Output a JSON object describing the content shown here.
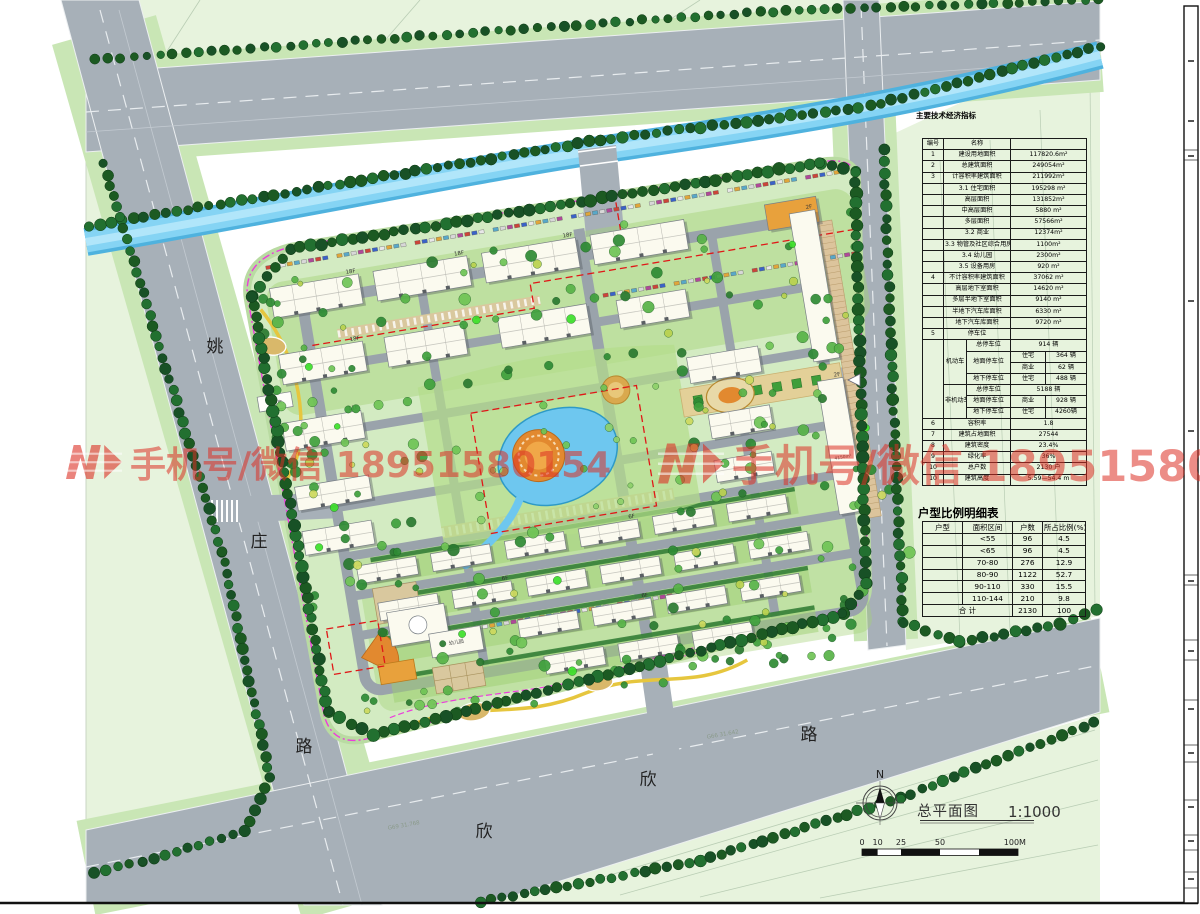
{
  "drawing": {
    "title": "总平面图",
    "scale": "1:1000",
    "north": "N",
    "scalebar_ticks": [
      "0",
      "10",
      "25",
      "50",
      "100M"
    ],
    "survey_labels": [
      "G66 31.642",
      "G69 31.768"
    ]
  },
  "roads": {
    "left": [
      "姚",
      "庄",
      "路"
    ],
    "bottom": [
      "欣",
      "欣",
      "路"
    ]
  },
  "watermark": {
    "text": "手机号/微信 18951580154"
  },
  "labels": {
    "floors": [
      "18F",
      "18F",
      "18F",
      "18F",
      "11F",
      "6F",
      "6F",
      "6F",
      "2F",
      "2F",
      "1F"
    ],
    "rooms": [
      "配电房",
      "幼儿园",
      "4150m²"
    ]
  },
  "colors": {
    "road": "#a7b0b8",
    "canal": "#6cc8ee",
    "site_green": "#d3ebc2",
    "field_green": "#e7f3dd",
    "tree_dark": "#1c5a22",
    "plaza_orange": "#e2892f",
    "boundary_magenta": "#ec3cdc",
    "redline": "#e01818",
    "watermark_red": "#dc3024"
  },
  "tables": {
    "main": {
      "title": "主要技术经济指标",
      "col_widths": [
        21,
        23,
        44,
        35,
        41
      ],
      "rows": [
        {
          "cells": [
            {
              "t": "编号"
            },
            {
              "t": "名称",
              "c": 2
            },
            {
              "t": "",
              "c": 2
            }
          ]
        },
        {
          "cells": [
            {
              "t": "1"
            },
            {
              "t": "建设用地面积",
              "c": 2
            },
            {
              "t": "117820.6m²",
              "c": 2
            }
          ]
        },
        {
          "cells": [
            {
              "t": "2"
            },
            {
              "t": "总建筑面积",
              "c": 2
            },
            {
              "t": "249054m²",
              "c": 2
            }
          ]
        },
        {
          "cells": [
            {
              "t": "3"
            },
            {
              "t": "计容积率建筑面积",
              "c": 2
            },
            {
              "t": "211992m²",
              "c": 2
            }
          ]
        },
        {
          "cells": [
            {
              "t": ""
            },
            {
              "t": "3.1 住宅面积",
              "c": 2
            },
            {
              "t": "195298 m²",
              "c": 2
            }
          ]
        },
        {
          "cells": [
            {
              "t": ""
            },
            {
              "t": "高层面积",
              "c": 2
            },
            {
              "t": "131852m²",
              "c": 2
            }
          ]
        },
        {
          "cells": [
            {
              "t": ""
            },
            {
              "t": "中高层面积",
              "c": 2
            },
            {
              "t": "5880 m²",
              "c": 2
            }
          ]
        },
        {
          "cells": [
            {
              "t": ""
            },
            {
              "t": "多层面积",
              "c": 2
            },
            {
              "t": "57566m²",
              "c": 2
            }
          ]
        },
        {
          "cells": [
            {
              "t": ""
            },
            {
              "t": "3.2 商业",
              "c": 2
            },
            {
              "t": "12374m²",
              "c": 2
            }
          ]
        },
        {
          "cells": [
            {
              "t": ""
            },
            {
              "t": "3.3 物管及社区综合用房",
              "c": 2
            },
            {
              "t": "1100m²",
              "c": 2
            }
          ]
        },
        {
          "cells": [
            {
              "t": ""
            },
            {
              "t": "3.4 幼儿园",
              "c": 2
            },
            {
              "t": "2300m²",
              "c": 2
            }
          ]
        },
        {
          "cells": [
            {
              "t": ""
            },
            {
              "t": "3.5 设备用房",
              "c": 2
            },
            {
              "t": "920 m²",
              "c": 2
            }
          ]
        },
        {
          "cells": [
            {
              "t": "4"
            },
            {
              "t": "不计容积率建筑面积",
              "c": 2
            },
            {
              "t": "37062 m²",
              "c": 2
            }
          ]
        },
        {
          "cells": [
            {
              "t": ""
            },
            {
              "t": "高层地下室面积",
              "c": 2
            },
            {
              "t": "14620 m²",
              "c": 2
            }
          ]
        },
        {
          "cells": [
            {
              "t": ""
            },
            {
              "t": "多层半地下室面积",
              "c": 2
            },
            {
              "t": "9140 m²",
              "c": 2
            }
          ]
        },
        {
          "cells": [
            {
              "t": ""
            },
            {
              "t": "半地下汽车库面积",
              "c": 2
            },
            {
              "t": "6330 m²",
              "c": 2
            }
          ]
        },
        {
          "cells": [
            {
              "t": ""
            },
            {
              "t": "地下汽车库面积",
              "c": 2
            },
            {
              "t": "9720 m²",
              "c": 2
            }
          ]
        },
        {
          "cells": [
            {
              "t": "5"
            },
            {
              "t": "停车位",
              "c": 2
            },
            {
              "t": "",
              "c": 2
            }
          ]
        },
        {
          "cells": [
            {
              "t": "",
              "r": 7
            },
            {
              "t": "机动车",
              "r": 4
            },
            {
              "t": "总停车位"
            },
            {
              "t": "914 辆",
              "c": 2
            }
          ]
        },
        {
          "cells": [
            {
              "t": "地面停车位",
              "r": 2
            },
            {
              "t": "住宅"
            },
            {
              "t": "364 辆"
            }
          ]
        },
        {
          "cells": [
            {
              "t": "商业"
            },
            {
              "t": "62 辆"
            }
          ]
        },
        {
          "cells": [
            {
              "t": "地下停车位"
            },
            {
              "t": "住宅"
            },
            {
              "t": "488 辆"
            }
          ]
        },
        {
          "cells": [
            {
              "t": "非机动车",
              "r": 3
            },
            {
              "t": "总停车位"
            },
            {
              "t": "5188 辆",
              "c": 2
            }
          ]
        },
        {
          "cells": [
            {
              "t": "地面停车位"
            },
            {
              "t": "商业"
            },
            {
              "t": "928 辆"
            }
          ]
        },
        {
          "cells": [
            {
              "t": "地下停车位"
            },
            {
              "t": "住宅"
            },
            {
              "t": "4260辆"
            }
          ]
        },
        {
          "cells": [
            {
              "t": "6"
            },
            {
              "t": "容积率",
              "c": 2
            },
            {
              "t": "1.8",
              "c": 2
            }
          ]
        },
        {
          "cells": [
            {
              "t": "7"
            },
            {
              "t": "建筑占地面积",
              "c": 2
            },
            {
              "t": "27544",
              "c": 2
            }
          ]
        },
        {
          "cells": [
            {
              "t": "8"
            },
            {
              "t": "建筑密度",
              "c": 2
            },
            {
              "t": "23.4%",
              "c": 2
            }
          ]
        },
        {
          "cells": [
            {
              "t": "9"
            },
            {
              "t": "绿化率",
              "c": 2
            },
            {
              "t": "36%",
              "c": 2
            }
          ]
        },
        {
          "cells": [
            {
              "t": "10"
            },
            {
              "t": "总户数",
              "c": 2
            },
            {
              "t": "2130 户",
              "c": 2
            }
          ]
        },
        {
          "cells": [
            {
              "t": "10"
            },
            {
              "t": "建筑高度",
              "c": 2
            },
            {
              "t": "5.59—54.4 m",
              "c": 2
            }
          ]
        }
      ]
    },
    "units": {
      "title": "户型比例明细表",
      "col_widths": [
        40,
        50,
        30,
        43
      ],
      "rows": [
        {
          "cells": [
            {
              "t": "户型"
            },
            {
              "t": "面积区间"
            },
            {
              "t": "户数"
            },
            {
              "t": "所占比例(%)"
            }
          ]
        },
        {
          "cells": [
            {
              "t": ""
            },
            {
              "t": "<55"
            },
            {
              "t": "96"
            },
            {
              "t": "4.5"
            }
          ]
        },
        {
          "cells": [
            {
              "t": ""
            },
            {
              "t": "<65"
            },
            {
              "t": "96"
            },
            {
              "t": "4.5"
            }
          ]
        },
        {
          "cells": [
            {
              "t": ""
            },
            {
              "t": "70-80"
            },
            {
              "t": "276"
            },
            {
              "t": "12.9"
            }
          ]
        },
        {
          "cells": [
            {
              "t": ""
            },
            {
              "t": "80-90"
            },
            {
              "t": "1122"
            },
            {
              "t": "52.7"
            }
          ]
        },
        {
          "cells": [
            {
              "t": ""
            },
            {
              "t": "90-110"
            },
            {
              "t": "330"
            },
            {
              "t": "15.5"
            }
          ]
        },
        {
          "cells": [
            {
              "t": ""
            },
            {
              "t": "110-144"
            },
            {
              "t": "210"
            },
            {
              "t": "9.8"
            }
          ]
        },
        {
          "cells": [
            {
              "t": "合  计",
              "c": 2
            },
            {
              "t": "2130"
            },
            {
              "t": "100"
            }
          ]
        }
      ]
    }
  }
}
